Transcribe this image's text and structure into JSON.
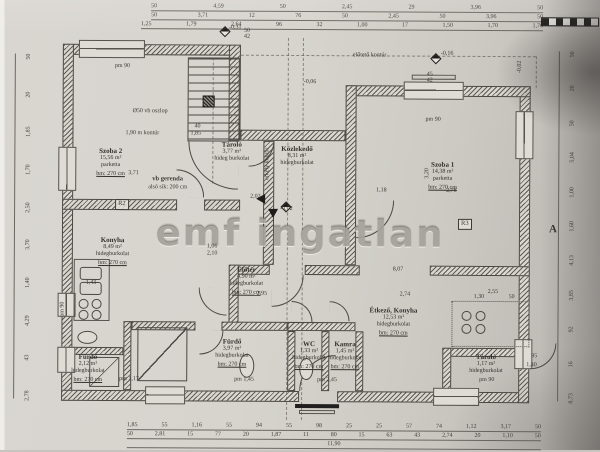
{
  "watermark": "emf ingatlan",
  "rooms": [
    {
      "id": "szoba-2",
      "name": "Szoba 2",
      "area": "15,56 m²",
      "floor": "parketta",
      "height": "bm: 270 cm",
      "x": 96,
      "y": 148
    },
    {
      "id": "tarolo-lepcso",
      "name": "Tároló",
      "area": "3,77 m²",
      "floor": "hideg burkolat",
      "x": 214,
      "y": 141
    },
    {
      "id": "kozlekedo",
      "name": "Közlekedő",
      "area": "8,31 m²",
      "floor": "hidegburkolat",
      "x": 280,
      "y": 145
    },
    {
      "id": "szoba-1",
      "name": "Szoba 1",
      "area": "14,38 m²",
      "floor": "parketta",
      "height": "bm: 270 cm",
      "x": 428,
      "y": 160
    },
    {
      "id": "konyha",
      "name": "Konyha",
      "area": "8,49 m²",
      "floor": "hidegburkolat",
      "height": "bm: 270 cm",
      "x": 96,
      "y": 237
    },
    {
      "id": "eloter",
      "name": "Előtér",
      "area": "4,90 m²",
      "floor": "hidegburkolat",
      "height": "bm: 270 cm",
      "x": 230,
      "y": 266
    },
    {
      "id": "furdo-1",
      "name": "Fürdő",
      "area": "2,12 m²",
      "floor": "hidegburkolat",
      "height": "bm: 270 cm",
      "x": 72,
      "y": 354
    },
    {
      "id": "furdo-2",
      "name": "Fürdő",
      "area": "3,97 m²",
      "floor": "hidegburkolat",
      "height": "bm: 270 cm",
      "x": 216,
      "y": 338
    },
    {
      "id": "wc",
      "name": "WC",
      "area": "1,33 m²",
      "floor": "hidegburkolat",
      "height": "bm: 270 cm",
      "x": 293,
      "y": 340
    },
    {
      "id": "kamra",
      "name": "Kamra",
      "area": "1,45 m²",
      "floor": "hidegburkolat",
      "height": "bm: 270 cm",
      "x": 329,
      "y": 340
    },
    {
      "id": "etkezo-konyha",
      "name": "Étkező, Konyha",
      "area": "12,53 m²",
      "floor": "hidegburkolat",
      "height": "bm: 270 cm",
      "x": 370,
      "y": 306
    },
    {
      "id": "tarolo-2",
      "name": "Tároló",
      "area": "1,17 m²",
      "floor": "hidegburkolat",
      "x": 470,
      "y": 352
    }
  ],
  "annotations": [
    {
      "text": "előtető kontúr",
      "x": 352,
      "y": 52,
      "name": "porch-contour-label"
    },
    {
      "text": "erkély kontúr",
      "x": 264,
      "y": 180,
      "rot": -90,
      "name": "balcony-contour-label"
    },
    {
      "text": "Ø50 vb oszlop",
      "x": 132,
      "y": 109,
      "name": "column-label"
    },
    {
      "text": "1,90 m kontúr",
      "x": 125,
      "y": 131,
      "name": "contour-label"
    },
    {
      "text": "vb gerenda",
      "x": 152,
      "y": 177,
      "cls": "b",
      "name": "beam-label"
    },
    {
      "text": "alsó sík: 200 cm",
      "x": 148,
      "y": 185,
      "name": "beam-sublabel"
    },
    {
      "text": "-0,31",
      "x": 228,
      "y": 25,
      "name": "level-mark"
    },
    {
      "text": "-0,16",
      "x": 440,
      "y": 50,
      "name": "level-mark"
    },
    {
      "text": "-0,02",
      "x": 516,
      "y": 72,
      "rot": -90,
      "name": "level-mark"
    },
    {
      "text": "-0,06",
      "x": 303,
      "y": 79,
      "name": "level-mark"
    },
    {
      "text": "-0,02",
      "x": 280,
      "y": 206,
      "name": "level-mark"
    },
    {
      "text": "pm 90",
      "x": 114,
      "y": 64,
      "name": "parapet-mark"
    },
    {
      "text": "pm 90",
      "x": 425,
      "y": 116,
      "name": "parapet-mark"
    },
    {
      "text": "pm 90",
      "x": 60,
      "y": 318,
      "rot": -90,
      "name": "parapet-mark"
    },
    {
      "text": "pm 90",
      "x": 480,
      "y": 376,
      "name": "parapet-mark"
    },
    {
      "text": "pm 1,17",
      "x": 120,
      "y": 377,
      "name": "parapet-mark"
    },
    {
      "text": "pm 1,45",
      "x": 235,
      "y": 377,
      "name": "parapet-mark"
    },
    {
      "text": "pm 2,45",
      "x": 318,
      "y": 377,
      "name": "parapet-mark"
    },
    {
      "text": "3,71",
      "x": 128,
      "y": 171
    },
    {
      "text": "1,43",
      "x": 86,
      "y": 281
    },
    {
      "text": "1,06",
      "x": 207,
      "y": 244
    },
    {
      "text": "2,10",
      "x": 207,
      "y": 251
    },
    {
      "text": "2,95",
      "x": 257,
      "y": 291
    },
    {
      "text": "8,07",
      "x": 393,
      "y": 266
    },
    {
      "text": "2,74",
      "x": 400,
      "y": 291
    },
    {
      "text": "1,18",
      "x": 376,
      "y": 187
    },
    {
      "text": "2,78",
      "x": 446,
      "y": 187
    },
    {
      "text": "3,20",
      "x": 424,
      "y": 178,
      "rot": -90
    },
    {
      "text": "2,02",
      "x": 250,
      "y": 194
    },
    {
      "text": "2,55",
      "x": 488,
      "y": 288
    },
    {
      "text": "1,30",
      "x": 474,
      "y": 293
    },
    {
      "text": "50",
      "x": 509,
      "y": 293
    },
    {
      "text": "95",
      "x": 532,
      "y": 352
    },
    {
      "text": "1,40",
      "x": 527,
      "y": 361
    },
    {
      "text": "40",
      "x": 194,
      "y": 124
    },
    {
      "text": "1,85",
      "x": 190,
      "y": 131
    },
    {
      "text": "50",
      "x": 243,
      "y": 28
    },
    {
      "text": "42",
      "x": 243,
      "y": 34
    },
    {
      "text": "45",
      "x": 426,
      "y": 71
    },
    {
      "text": "42",
      "x": 426,
      "y": 77
    },
    {
      "text": "R2",
      "x": 115,
      "y": 200,
      "cls": "ref",
      "name": "room-ref"
    },
    {
      "text": "R3",
      "x": 458,
      "y": 218,
      "cls": "ref",
      "name": "room-ref"
    },
    {
      "text": "A",
      "x": 549,
      "y": 223,
      "cls": "sec",
      "name": "section-marker"
    }
  ],
  "dimensions": {
    "top": [
      [
        "50",
        "4,59",
        "50",
        "2,45",
        "29",
        "3,96",
        "50"
      ],
      [
        "50",
        "3,71",
        "12",
        "76",
        "50",
        "2,45",
        "50",
        "3,96",
        "50"
      ],
      [
        "1,25",
        "1,79",
        "2,64",
        "96",
        "32",
        "1,00",
        "17",
        "1,50",
        "1,70",
        "1,76"
      ]
    ],
    "bottom": [
      [
        "1,85",
        "55",
        "1,16",
        "55",
        "94",
        "55",
        "98",
        "25",
        "25",
        "57",
        "74",
        "1,12",
        "3,17",
        "50"
      ],
      [
        "50",
        "2,81",
        "15",
        "77",
        "20",
        "1,87",
        "11",
        "80",
        "15",
        "63",
        "43",
        "2,74",
        "20",
        "1,10",
        "50"
      ],
      [
        "11,90"
      ]
    ],
    "left": [
      "50",
      "20",
      "1,85",
      "1,70",
      "2,50",
      "3,70",
      "1,40",
      "4,29",
      "43",
      "2,78"
    ],
    "right": [
      "50",
      "20",
      "50",
      "5,04",
      "1,00",
      "1,60",
      "4,13",
      "3,85",
      "92",
      "16",
      "8,73"
    ]
  }
}
